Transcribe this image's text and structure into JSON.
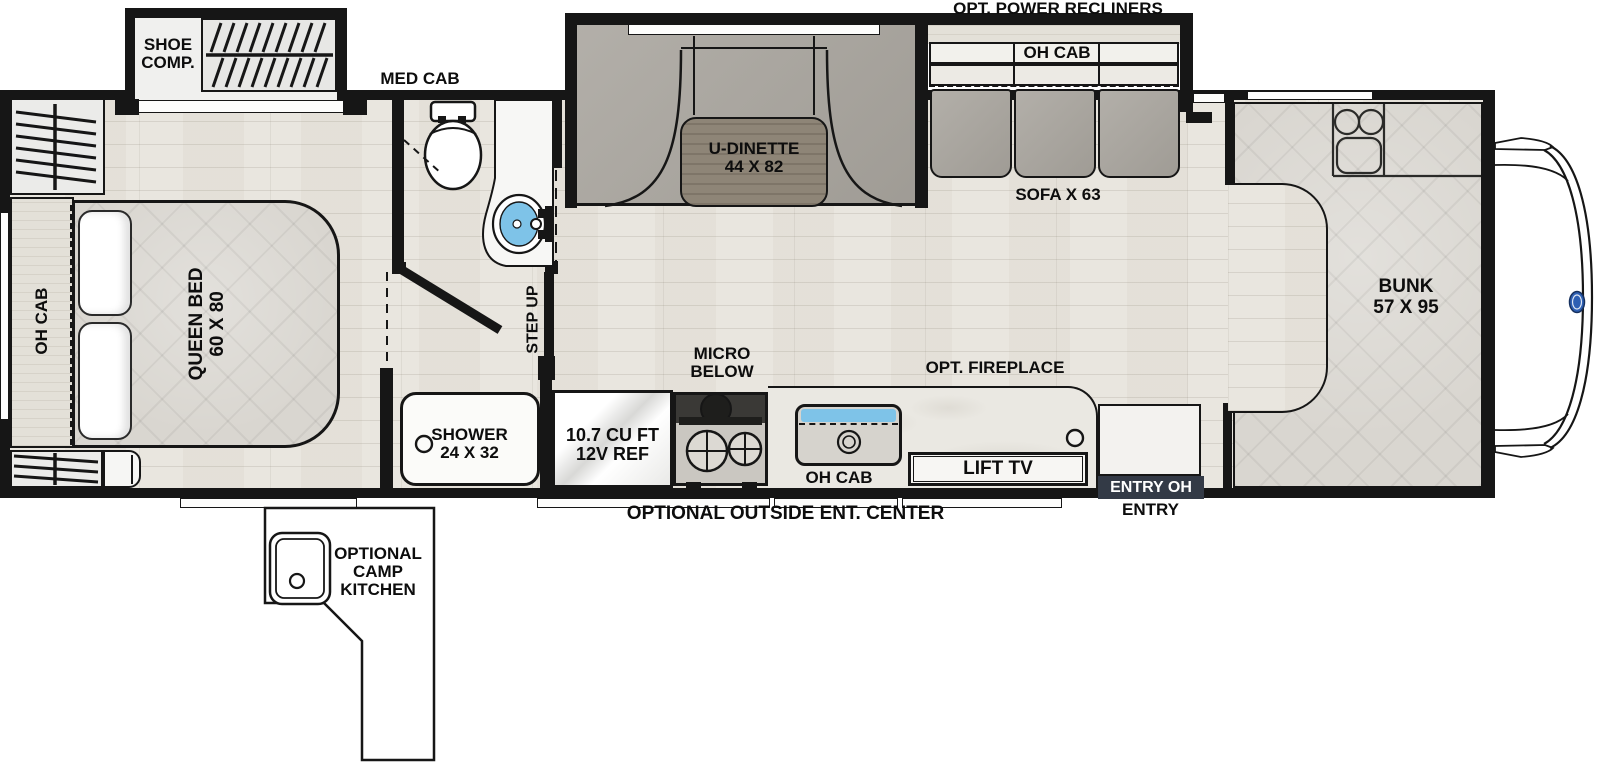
{
  "colors": {
    "wall": "#161616",
    "floor_wood": "#e9e6df",
    "mattress_quilt": "#d9d6d0",
    "upholstery_gray": "#a8a49d",
    "table_wood": "#8e8577",
    "sink_blue": "#7ec3e8",
    "entry_bar": "#333a46",
    "ford_logo_blue": "#2d5fb3"
  },
  "slides": {
    "power_recliners": "OPT. POWER RECLINERS",
    "shoe_comp": {
      "line1": "SHOE",
      "line2": "COMP."
    },
    "dinette": {
      "name": "U-DINETTE",
      "size": "44 X 82"
    },
    "sofa": {
      "oh_cab": "OH CAB",
      "label": "SOFA X 63"
    }
  },
  "bedroom": {
    "oh_cab": "OH CAB",
    "bed_name": "QUEEN BED",
    "bed_size": "60 X 80"
  },
  "bathroom": {
    "med_cab": "MED CAB",
    "step_up": "STEP UP",
    "shower_name": "SHOWER",
    "shower_size": "24 X 32"
  },
  "kitchen": {
    "fridge_line1": "10.7 CU FT",
    "fridge_line2": "12V REF",
    "micro_line1": "MICRO",
    "micro_line2": "BELOW",
    "fireplace": "OPT. FIREPLACE",
    "lift_tv": "LIFT TV",
    "oh_cab": "OH CAB",
    "outside_center": "OPTIONAL OUTSIDE ENT. CENTER"
  },
  "entry": {
    "overhead": "ENTRY OH",
    "door": "ENTRY"
  },
  "bunk": {
    "name": "BUNK",
    "size": "57 X 95"
  },
  "camp_kitchen": {
    "line1": "OPTIONAL",
    "line2": "CAMP",
    "line3": "KITCHEN"
  }
}
